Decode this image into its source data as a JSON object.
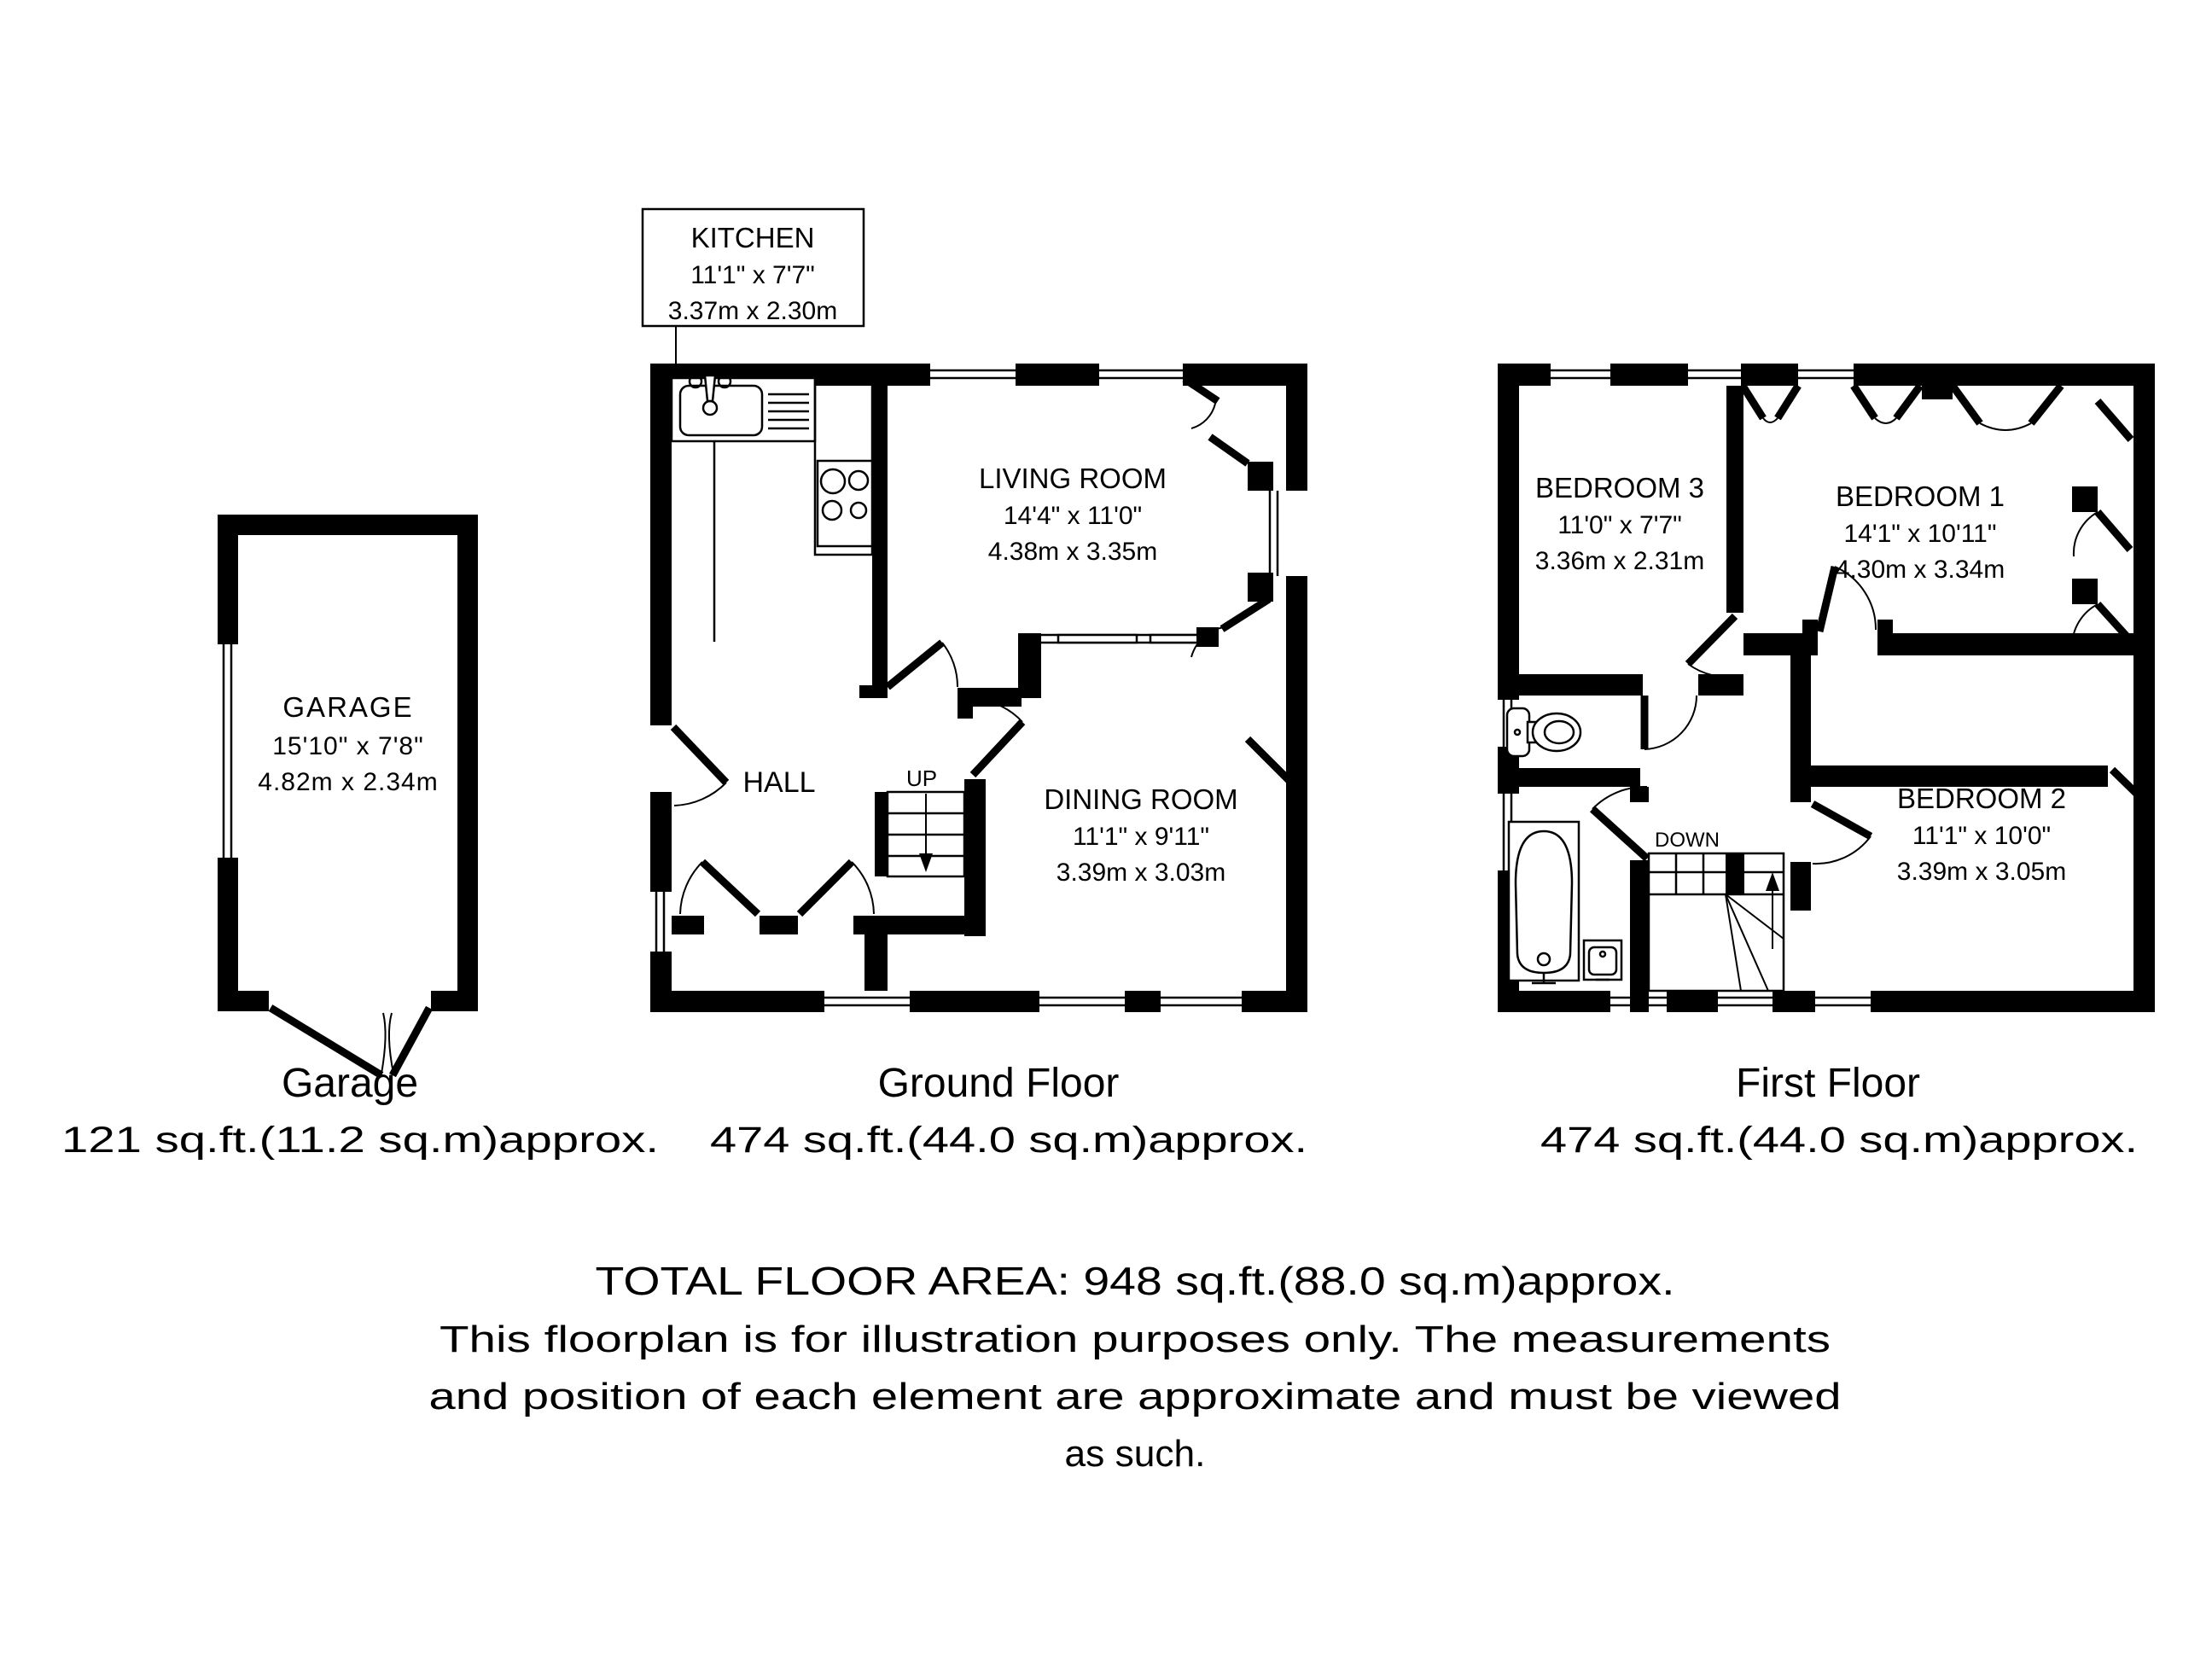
{
  "rooms": {
    "kitchen": {
      "name": "KITCHEN",
      "imperial": "11'1\" x 7'7\"",
      "metric": "3.37m x 2.30m"
    },
    "living": {
      "name": "LIVING ROOM",
      "imperial": "14'4\" x 11'0\"",
      "metric": "4.38m x 3.35m"
    },
    "dining": {
      "name": "DINING ROOM",
      "imperial": "11'1\" x 9'11\"",
      "metric": "3.39m x 3.03m"
    },
    "hall": {
      "name": "HALL"
    },
    "garage": {
      "name": "GARAGE",
      "imperial": "15'10\" x 7'8\"",
      "metric": "4.82m x 2.34m"
    },
    "bedroom1": {
      "name": "BEDROOM 1",
      "imperial": "14'1\" x 10'11\"",
      "metric": "4.30m x 3.34m"
    },
    "bedroom2": {
      "name": "BEDROOM 2",
      "imperial": "11'1\" x 10'0\"",
      "metric": "3.39m x 3.05m"
    },
    "bedroom3": {
      "name": "BEDROOM 3",
      "imperial": "11'0\" x 7'7\"",
      "metric": "3.36m x 2.31m"
    }
  },
  "stairs": {
    "up": "UP",
    "down": "DOWN"
  },
  "captions": {
    "garage": {
      "title": "Garage",
      "area": "121 sq.ft.(11.2 sq.m)approx."
    },
    "ground_floor": {
      "title": "Ground Floor",
      "area": "474 sq.ft.(44.0 sq.m)approx."
    },
    "first_floor": {
      "title": "First Floor",
      "area": "474 sq.ft.(44.0 sq.m)approx."
    }
  },
  "footer": {
    "total_area": "TOTAL FLOOR AREA: 948 sq.ft.(88.0 sq.m)approx.",
    "disclaimer_line1": "This floorplan is for illustration purposes only. The measurements",
    "disclaimer_line2": "and position of each element are approximate and must be viewed",
    "disclaimer_line3": "as such."
  },
  "colors": {
    "wall": "#000000",
    "background": "#ffffff"
  }
}
